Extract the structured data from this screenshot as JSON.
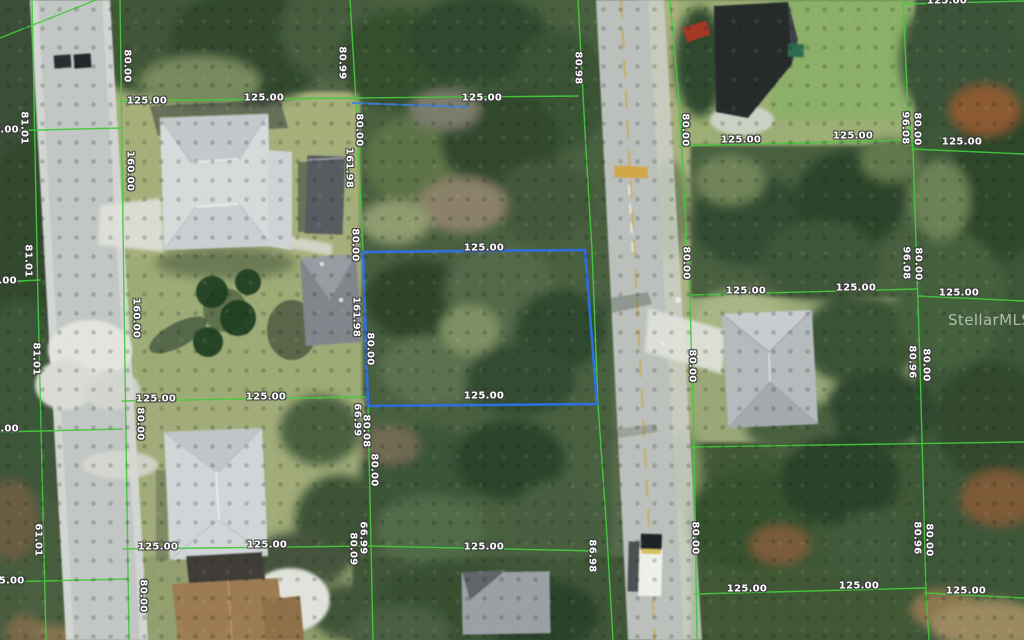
{
  "map": {
    "type": "aerial-parcel-view",
    "watermark": "StellarMLS",
    "highlight_parcel": {
      "outline_color": "#2e6fe0",
      "width_label": "125.00",
      "side_labels": [
        "161.98",
        "80.00"
      ]
    }
  },
  "colors": {
    "parcel_line_green": "#46c93e",
    "highlight_blue": "#2e6fe0",
    "label_text": "#ffffff",
    "label_outline": "#3e3e3e",
    "road_gray": "#bcc0bd",
    "forest_green": "#49603f"
  },
  "labels": [
    {
      "t": "125.00",
      "x": 147,
      "y": 101,
      "r": 0
    },
    {
      "t": "125.00",
      "x": 264,
      "y": 98,
      "r": 0
    },
    {
      "t": "125.00",
      "x": 482,
      "y": 98,
      "r": 0
    },
    {
      "t": "125.00",
      "x": 484,
      "y": 248,
      "r": 0
    },
    {
      "t": "125.00",
      "x": 156,
      "y": 399,
      "r": 0
    },
    {
      "t": "125.00",
      "x": 266,
      "y": 397,
      "r": 0
    },
    {
      "t": "125.00",
      "x": 484,
      "y": 396,
      "r": 0
    },
    {
      "t": "125.00",
      "x": 158,
      "y": 547,
      "r": 0
    },
    {
      "t": "125.00",
      "x": 267,
      "y": 545,
      "r": 0
    },
    {
      "t": "125.00",
      "x": 484,
      "y": 547,
      "r": 0
    },
    {
      "t": "125.00",
      "x": 741,
      "y": 140,
      "r": 0
    },
    {
      "t": "125.00",
      "x": 853,
      "y": 136,
      "r": 0
    },
    {
      "t": "125.00",
      "x": 962,
      "y": 142,
      "r": 0
    },
    {
      "t": "125.00",
      "x": 746,
      "y": 291,
      "r": 0
    },
    {
      "t": "125.00",
      "x": 856,
      "y": 288,
      "r": 0
    },
    {
      "t": "125.00",
      "x": 959,
      "y": 293,
      "r": 0
    },
    {
      "t": "125.00",
      "x": 747,
      "y": 589,
      "r": 0
    },
    {
      "t": "125.00",
      "x": 859,
      "y": 586,
      "r": 0
    },
    {
      "t": "125.00",
      "x": 966,
      "y": 591,
      "r": 0
    },
    {
      "t": "25.00",
      "x": 8,
      "y": 581,
      "r": 0
    },
    {
      "t": "5.00",
      "x": 6,
      "y": 130,
      "r": 0
    },
    {
      "t": "6.00",
      "x": 4,
      "y": 281,
      "r": 0
    },
    {
      "t": "5.00",
      "x": 6,
      "y": 429,
      "r": 0
    },
    {
      "t": "125.00",
      "x": 947,
      "y": 1,
      "r": 0
    },
    {
      "t": "80.00",
      "x": 127,
      "y": 66,
      "r": 90
    },
    {
      "t": "160.00",
      "x": 130,
      "y": 171,
      "r": 90
    },
    {
      "t": "160.00",
      "x": 136,
      "y": 318,
      "r": 90
    },
    {
      "t": "80.00",
      "x": 140,
      "y": 424,
      "r": 90
    },
    {
      "t": "80.00",
      "x": 143,
      "y": 596,
      "r": 90
    },
    {
      "t": "81.01",
      "x": 24,
      "y": 128,
      "r": 90
    },
    {
      "t": "81.01",
      "x": 28,
      "y": 261,
      "r": 90
    },
    {
      "t": "81.01",
      "x": 36,
      "y": 359,
      "r": 90
    },
    {
      "t": "61.01",
      "x": 38,
      "y": 540,
      "r": 90
    },
    {
      "t": "80.99",
      "x": 342,
      "y": 63,
      "r": 90
    },
    {
      "t": "80.00",
      "x": 359,
      "y": 130,
      "r": 90
    },
    {
      "t": "161.98",
      "x": 349,
      "y": 168,
      "r": 90
    },
    {
      "t": "80.00",
      "x": 355,
      "y": 245,
      "r": 90
    },
    {
      "t": "161.98",
      "x": 356,
      "y": 317,
      "r": 90
    },
    {
      "t": "80.00",
      "x": 370,
      "y": 349,
      "r": 90
    },
    {
      "t": "66.99",
      "x": 357,
      "y": 420,
      "r": 90
    },
    {
      "t": "80.08",
      "x": 366,
      "y": 431,
      "r": 90
    },
    {
      "t": "80.00",
      "x": 374,
      "y": 470,
      "r": 90
    },
    {
      "t": "66.99",
      "x": 363,
      "y": 538,
      "r": 90
    },
    {
      "t": "80.09",
      "x": 353,
      "y": 549,
      "r": 90
    },
    {
      "t": "80.98",
      "x": 578,
      "y": 68,
      "r": 90
    },
    {
      "t": "86.98",
      "x": 592,
      "y": 556,
      "r": 90
    },
    {
      "t": "80.00",
      "x": 685,
      "y": 130,
      "r": 90
    },
    {
      "t": "80.00",
      "x": 686,
      "y": 263,
      "r": 90
    },
    {
      "t": "80.00",
      "x": 692,
      "y": 366,
      "r": 90
    },
    {
      "t": "80.00",
      "x": 695,
      "y": 538,
      "r": 90
    },
    {
      "t": "96.08",
      "x": 905,
      "y": 128,
      "r": 90
    },
    {
      "t": "80.00",
      "x": 917,
      "y": 129,
      "r": 90
    },
    {
      "t": "96.08",
      "x": 906,
      "y": 263,
      "r": 90
    },
    {
      "t": "80.00",
      "x": 918,
      "y": 264,
      "r": 90
    },
    {
      "t": "80.96",
      "x": 912,
      "y": 362,
      "r": 90
    },
    {
      "t": "80.00",
      "x": 926,
      "y": 365,
      "r": 90
    },
    {
      "t": "80.96",
      "x": 917,
      "y": 538,
      "r": 90
    },
    {
      "t": "80.00",
      "x": 929,
      "y": 540,
      "r": 90
    }
  ]
}
